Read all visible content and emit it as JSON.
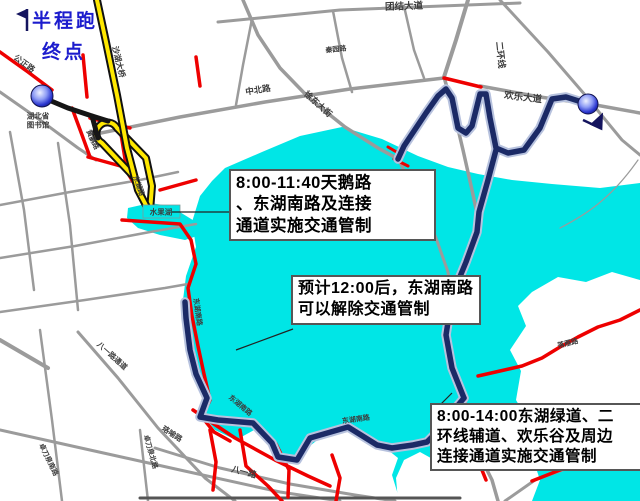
{
  "page": {
    "width": 640,
    "height": 501,
    "background": "#ffffff"
  },
  "colors": {
    "lake_cyan": "#00e6e6",
    "route_navy": "#1b2a66",
    "route_halo": "#b7c2de",
    "road_red": "#ee0000",
    "road_yellow": "#ffe800",
    "road_gray": "#9b9b9b",
    "road_black": "#151515",
    "title_blue": "#1c1ccd"
  },
  "title": {
    "line1": "半程跑",
    "line2": "终点"
  },
  "callouts": [
    {
      "lines": [
        "8:00-11:40天鹅路",
        "、东湖南路及连接",
        "通道实施交通管制"
      ]
    },
    {
      "lines": [
        "预计12:00后，东湖南路",
        "可以解除交通管制"
      ]
    },
    {
      "lines": [
        "8:00-14:00东湖绿道、二",
        "环线辅道、欢乐谷及周边",
        "连接通道实施交通管制"
      ]
    }
  ],
  "road_labels": [
    {
      "text": "公正路",
      "x": 24,
      "y": 64,
      "rot": 36,
      "size": 8
    },
    {
      "text": "湖北省",
      "x": 38,
      "y": 116,
      "rot": 0,
      "size": 7.5
    },
    {
      "text": "图书馆",
      "x": 38,
      "y": 125,
      "rot": 0,
      "size": 7.5
    },
    {
      "text": "沙湖大桥",
      "x": 118,
      "y": 62,
      "rot": 76,
      "size": 8
    },
    {
      "text": "黄鹂路",
      "x": 92,
      "y": 140,
      "rot": 65,
      "size": 7
    },
    {
      "text": "东湖路",
      "x": 138,
      "y": 186,
      "rot": 70,
      "size": 7
    },
    {
      "text": "水果湖",
      "x": 161,
      "y": 212,
      "rot": 0,
      "size": 7.5
    },
    {
      "text": "中北路",
      "x": 258,
      "y": 90,
      "rot": -9,
      "size": 8.5
    },
    {
      "text": "徐东大街",
      "x": 318,
      "y": 104,
      "rot": 42,
      "size": 8.5
    },
    {
      "text": "秦园路",
      "x": 336,
      "y": 50,
      "rot": -6,
      "size": 7
    },
    {
      "text": "团结大道",
      "x": 404,
      "y": 7,
      "rot": -2,
      "size": 9.5
    },
    {
      "text": "二环线",
      "x": 500,
      "y": 55,
      "rot": 84,
      "size": 9
    },
    {
      "text": "欢乐大道",
      "x": 523,
      "y": 98,
      "rot": 7,
      "size": 9.5
    },
    {
      "text": "东湖南路",
      "x": 197,
      "y": 312,
      "rot": 82,
      "size": 7
    },
    {
      "text": "东湖南路",
      "x": 240,
      "y": 406,
      "rot": 40,
      "size": 7
    },
    {
      "text": "东湖南路",
      "x": 356,
      "y": 420,
      "rot": -8,
      "size": 7
    },
    {
      "text": "八一路通道",
      "x": 112,
      "y": 356,
      "rot": 42,
      "size": 7.5
    },
    {
      "text": "八一路",
      "x": 244,
      "y": 472,
      "rot": 15,
      "size": 8.5
    },
    {
      "text": "珞喻路",
      "x": 172,
      "y": 434,
      "rot": 33,
      "size": 7.5
    },
    {
      "text": "卓刀泉北路",
      "x": 150,
      "y": 452,
      "rot": 74,
      "size": 7
    },
    {
      "text": "卓刀泉南路",
      "x": 48,
      "y": 460,
      "rot": 64,
      "size": 7
    },
    {
      "text": "鲁磨路",
      "x": 473,
      "y": 436,
      "rot": 82,
      "size": 7
    },
    {
      "text": "落雁路",
      "x": 568,
      "y": 344,
      "rot": -14,
      "size": 7
    }
  ]
}
